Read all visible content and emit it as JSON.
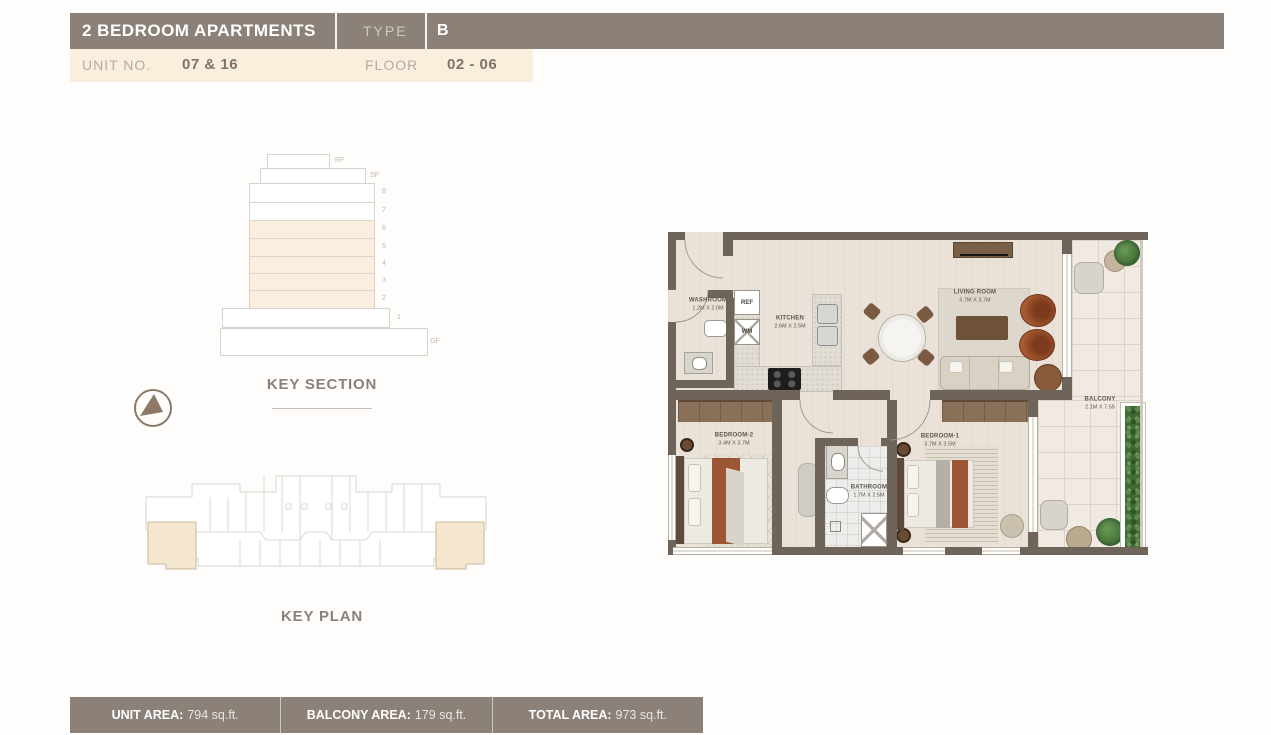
{
  "header": {
    "title": "2 BEDROOM APARTMENTS",
    "type_label": "TYPE",
    "type_value": "B",
    "unit_label": "UNIT NO.",
    "unit_value": "07 & 16",
    "floor_label": "FLOOR",
    "floor_value": "02 - 06"
  },
  "key_section": {
    "title": "KEY SECTION",
    "floors": [
      {
        "label": "RF",
        "highlighted": false
      },
      {
        "label": "SF",
        "highlighted": false
      },
      {
        "label": "8",
        "highlighted": false
      },
      {
        "label": "7",
        "highlighted": false
      },
      {
        "label": "6",
        "highlighted": true
      },
      {
        "label": "5",
        "highlighted": true
      },
      {
        "label": "4",
        "highlighted": true
      },
      {
        "label": "3",
        "highlighted": true
      },
      {
        "label": "2",
        "highlighted": true
      },
      {
        "label": "1",
        "highlighted": false
      },
      {
        "label": "GF",
        "highlighted": false
      }
    ]
  },
  "key_plan": {
    "title": "KEY PLAN"
  },
  "floor_plan": {
    "rooms": [
      {
        "name": "WASHROOM",
        "dims": "1.2M X 2.0M"
      },
      {
        "name": "KITCHEN",
        "dims": "2.6M X 2.5M"
      },
      {
        "name": "LIVING ROOM",
        "dims": "5.7M X 3.7M"
      },
      {
        "name": "BEDROOM-2",
        "dims": "3.4M X 3.7M"
      },
      {
        "name": "BATHROOM",
        "dims": "1.7M X 2.5M"
      },
      {
        "name": "BEDROOM-1",
        "dims": "3.7M X 3.5M"
      },
      {
        "name": "BALCONY",
        "dims": "2.1M X 7.55"
      }
    ],
    "appliances": {
      "ref": "REF",
      "wm": "WM"
    }
  },
  "footer": {
    "items": [
      {
        "label": "UNIT AREA:",
        "value": "794 sq.ft."
      },
      {
        "label": "BALCONY AREA:",
        "value": "179 sq.ft."
      },
      {
        "label": "TOTAL AREA:",
        "value": "973 sq.ft."
      }
    ]
  },
  "colors": {
    "header_bar": "#8b8178",
    "subheader_bar": "#fbeedd",
    "highlight_floor": "#fbeede",
    "wall": "#6e6459",
    "accent_text": "#8b8178",
    "footer_bar": "#8b8178",
    "hedge_green": "#3f6b35",
    "rust_furniture": "#9c5636"
  }
}
